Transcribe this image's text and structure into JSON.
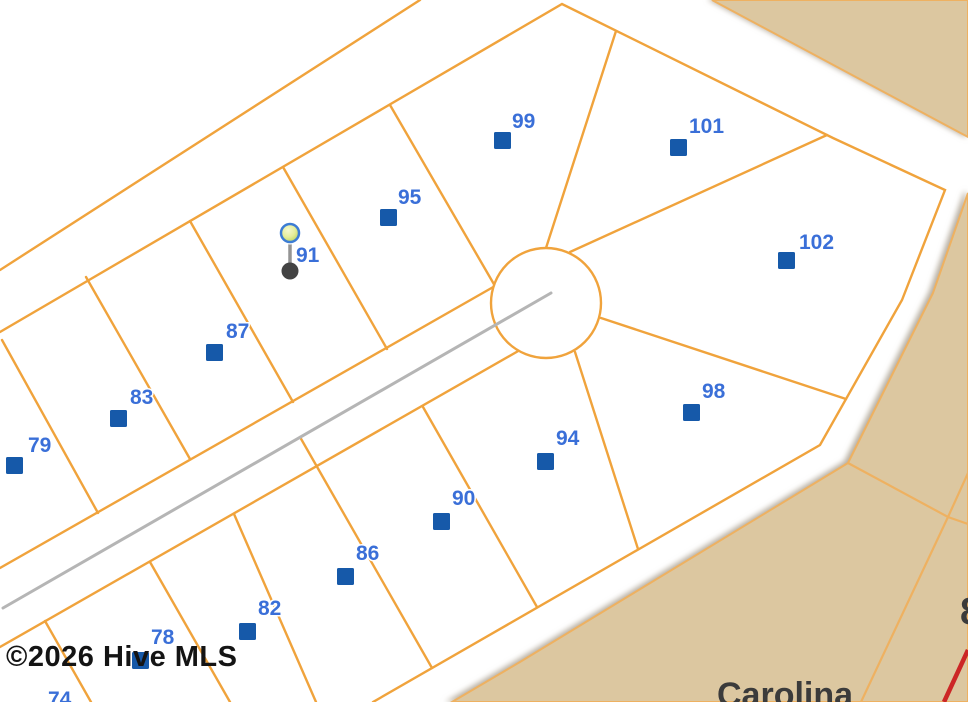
{
  "map": {
    "watermark": "©2026 Hive MLS",
    "place_label": "Carolina",
    "edge_partial_label": "8",
    "subject_pin_lot": "91",
    "colors": {
      "lot_line": "#f0a33c",
      "boundary_light": "#eeb161",
      "tan": "#dcc7a0",
      "road_centerline": "#b5b5b5",
      "highway_red": "#cc2626",
      "marker_blue": "#1659a9",
      "label_blue": "#3a6fd8",
      "pin_head_fill": "#e5ee9a",
      "pin_head_stroke": "#3c7cd4",
      "pin_stem": "#949494",
      "pin_base": "#434343",
      "text_dark": "#3b3b3b",
      "watermark": "#141414"
    },
    "lots": [
      {
        "number": "79",
        "marker": "square",
        "mx": 6,
        "my": 457,
        "lx": 28,
        "ly": 452
      },
      {
        "number": "83",
        "marker": "square",
        "mx": 110,
        "my": 410,
        "lx": 130,
        "ly": 404
      },
      {
        "number": "87",
        "marker": "square",
        "mx": 206,
        "my": 344,
        "lx": 226,
        "ly": 338
      },
      {
        "number": "91",
        "marker": "pin",
        "mx": 290,
        "my": 271,
        "lx": 296,
        "ly": 262
      },
      {
        "number": "95",
        "marker": "square",
        "mx": 380,
        "my": 209,
        "lx": 398,
        "ly": 204
      },
      {
        "number": "99",
        "marker": "square",
        "mx": 494,
        "my": 132,
        "lx": 512,
        "ly": 128
      },
      {
        "number": "101",
        "marker": "square",
        "mx": 670,
        "my": 139,
        "lx": 689,
        "ly": 133
      },
      {
        "number": "102",
        "marker": "square",
        "mx": 778,
        "my": 252,
        "lx": 799,
        "ly": 249
      },
      {
        "number": "98",
        "marker": "square",
        "mx": 683,
        "my": 404,
        "lx": 702,
        "ly": 398
      },
      {
        "number": "94",
        "marker": "square",
        "mx": 537,
        "my": 453,
        "lx": 556,
        "ly": 445
      },
      {
        "number": "90",
        "marker": "square",
        "mx": 433,
        "my": 513,
        "lx": 452,
        "ly": 505
      },
      {
        "number": "86",
        "marker": "square",
        "mx": 337,
        "my": 568,
        "lx": 356,
        "ly": 560
      },
      {
        "number": "82",
        "marker": "square",
        "mx": 239,
        "my": 623,
        "lx": 258,
        "ly": 615
      },
      {
        "number": "78",
        "marker": "square",
        "mx": 132,
        "my": 652,
        "lx": 151,
        "ly": 644
      },
      {
        "number": "74",
        "marker": "none",
        "mx": 0,
        "my": 0,
        "lx": 48,
        "ly": 706
      }
    ]
  }
}
